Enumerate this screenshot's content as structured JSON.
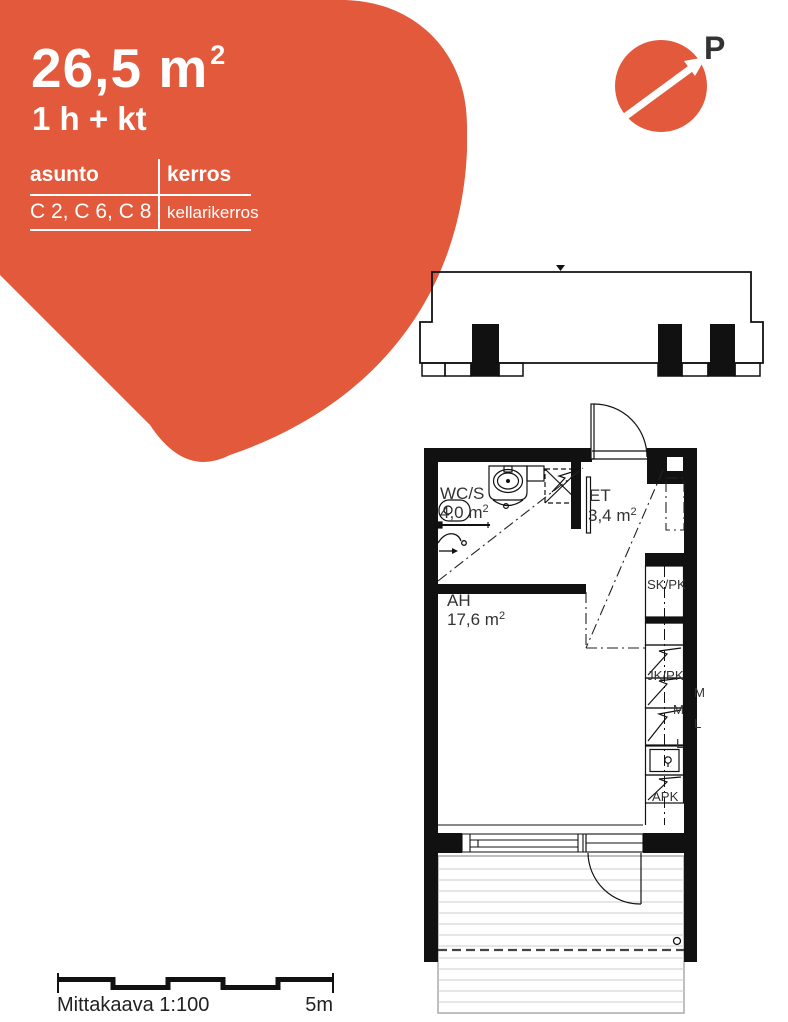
{
  "colors": {
    "accent": "#e2593c",
    "wall": "#111111",
    "deck_line": "#cccccc"
  },
  "unit_card": {
    "area_value": "26,5 m",
    "area_exponent": "2",
    "unit_type": "1 h + kt",
    "table": {
      "apartment_header": "asunto",
      "floor_header": "kerros",
      "apartment_value": "C 2, C 6, C 8",
      "floor_value": "kellarikerros"
    }
  },
  "north_indicator": {
    "label": "P"
  },
  "floor_plan": {
    "rooms": [
      {
        "name": "WC/S",
        "area": "4,0 m",
        "exp": "2"
      },
      {
        "name": "ET",
        "area": "3,4 m",
        "exp": "2"
      },
      {
        "name": "AH",
        "area": "17,6 m",
        "exp": "2"
      }
    ],
    "kitchen_labels": {
      "sk_pk": "SK/PK",
      "jk_pk": "JK/PK",
      "m_outer": "M",
      "m_inner": "M",
      "l_outer": "L",
      "l_inner": "L",
      "apk": "APK"
    }
  },
  "scale_bar": {
    "label": "Mittakaava 1:100",
    "end_label": "5m"
  }
}
